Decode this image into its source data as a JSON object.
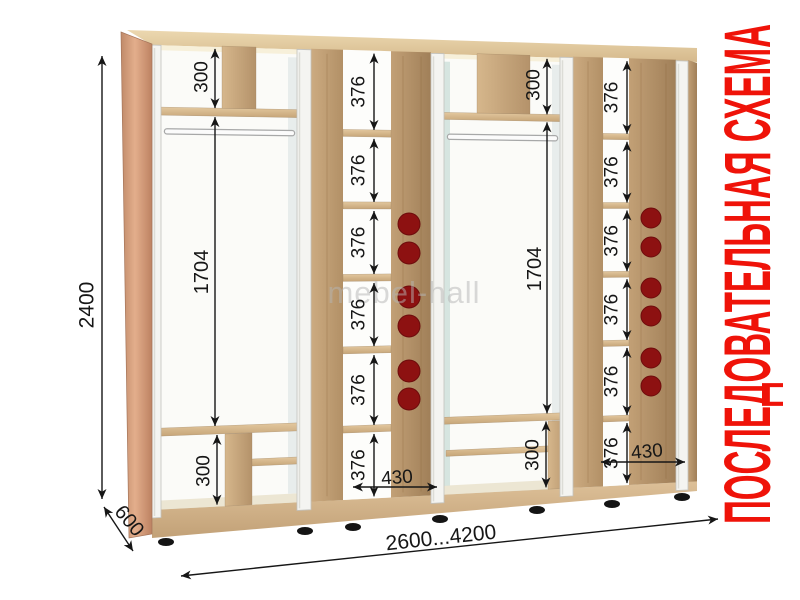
{
  "diagram": {
    "side_title": "ПОСЛЕДОВАТЕЛЬНАЯ СХЕМА",
    "watermark": "mebel-hall"
  },
  "overall": {
    "height": "2400",
    "depth": "600",
    "width_range": "2600...4200"
  },
  "hanging_section": {
    "top_compartment": "300",
    "hanging_space": "1704",
    "bottom_compartment": "300",
    "count": 2
  },
  "shelf_column": {
    "shelf_pitch": "376",
    "pitch_labels_per_column": 6,
    "shelf_width": "430",
    "knobs_per_column": 6,
    "count": 2
  },
  "colors": {
    "title_red": "#ef1309",
    "knob_red": "#8d1111",
    "dimension_ink": "#161616",
    "wood_light": "#e3c89f",
    "wood_mid": "#c09e74",
    "side_wood": "#d8a987",
    "profile_white": "#f4f4f1",
    "watermark_gray": "#b5b5b5"
  }
}
